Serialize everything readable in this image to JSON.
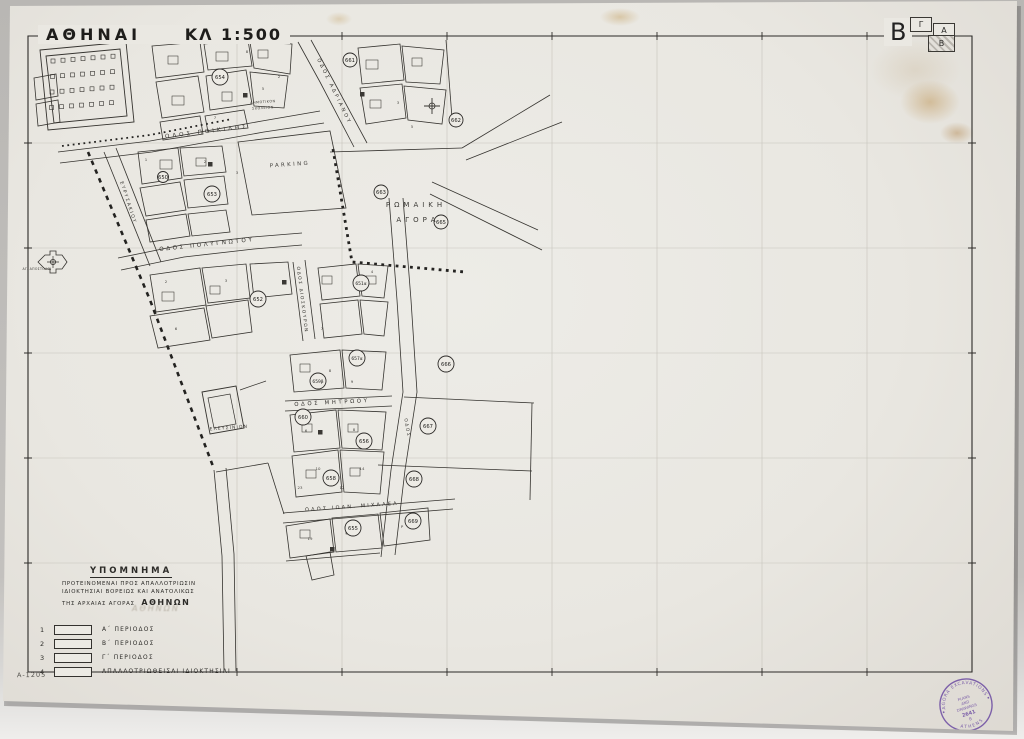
{
  "sheet": {
    "title": "ΑΘΗΝΑΙ",
    "scale": "ΚΛ 1:500",
    "sheet_letter": "B",
    "ref_number": "A-1205",
    "index_boxes": [
      {
        "label": "Γ"
      },
      {
        "label": "Α"
      },
      {
        "label": "Β"
      }
    ]
  },
  "legend": {
    "title": "ΥΠΟΜΝΗΜΑ",
    "subtitle_lines": [
      "ΠΡΟΤΕΙΝΟΜΕΝΑΙ ΠΡΟΣ ΑΠΑΛΛΟΤΡΙΩΣΙΝ",
      "ΙΔΙΟΚΤΗΣΙΑΙ ΒΟΡΕΙΩΣ ΚΑΙ ΑΝΑΤΟΛΙΚΩΣ",
      "ΤΗΣ ΑΡΧΑΙΑΣ ΑΓΟΡΑΣ"
    ],
    "highlight": "ΑΘΗΝΩΝ",
    "pencil_note": "ΑΘΗΝΩΝ",
    "items": [
      {
        "num": "1",
        "label": "Α΄ ΠΕΡΙΟΔΟΣ"
      },
      {
        "num": "2",
        "label": "Β΄ ΠΕΡΙΟΔΟΣ"
      },
      {
        "num": "3",
        "label": "Γ΄ ΠΕΡΙΟΔΟΣ"
      },
      {
        "num": "4",
        "label": "ΑΠΑΛΛΟΤΡΙΩΘΕΙΣΑΙ ΙΔΙΟΚΤΗΣΙΑΙ"
      }
    ]
  },
  "stamp": {
    "rim_top": "AGORA EXCAVATIONS",
    "rim_bottom": "ATHENS",
    "center_lines": [
      "PLANS",
      "AND",
      "DRAWINGS"
    ],
    "number": "2641",
    "letter": "Β",
    "color": "#6f4fa3"
  },
  "map": {
    "ink_color": "#35332f",
    "area_labels": [
      {
        "text": "ΡΩΜΑΙΚΗ",
        "x": 416,
        "y": 207,
        "fs": 7,
        "ls": 4,
        "rot": 0
      },
      {
        "text": "ΑΓΟΡΑ",
        "x": 418,
        "y": 222,
        "fs": 7,
        "ls": 4,
        "rot": 0
      },
      {
        "text": "PARKING",
        "x": 290,
        "y": 166,
        "fs": 5.4,
        "ls": 2.4,
        "rot": -4
      },
      {
        "text": "ΕΛΕΥΣΙΝΙΟΝ",
        "x": 229,
        "y": 429,
        "fs": 4.4,
        "ls": 1.2,
        "rot": -4
      },
      {
        "text": "ΑΓ. ΑΠΟΣΤΟΛΟΙ",
        "x": 37,
        "y": 270,
        "fs": 3.2,
        "ls": 0.3,
        "rot": 0
      },
      {
        "text": "ΔΗΜΟΤΙΚΟΝ",
        "x": 263,
        "y": 103,
        "fs": 3.4,
        "ls": 0.5,
        "rot": -4
      },
      {
        "text": "ΣΧΟΛΕΙΟΝ",
        "x": 263,
        "y": 109,
        "fs": 3.4,
        "ls": 0.5,
        "rot": -4
      }
    ],
    "street_labels": [
      {
        "text": "ΟΔΟΣ ΠΟΙΚΙΛΗΣ",
        "x": 207,
        "y": 133,
        "rot": -7,
        "fs": 5.6,
        "ls": 3
      },
      {
        "text": "ΟΔΟΣ ΠΟΛΥΓΝΩΤΟΥ",
        "x": 207,
        "y": 246,
        "rot": -6,
        "fs": 5.6,
        "ls": 2.6
      },
      {
        "text": "ΟΔΟΣ ΑΔΡΙΑΝΟΥ",
        "x": 333,
        "y": 92,
        "rot": 64,
        "fs": 5,
        "ls": 2.4
      },
      {
        "text": "ΕΥΡΥΣΑΚΙΟΥ",
        "x": 127,
        "y": 203,
        "rot": 72,
        "fs": 4.6,
        "ls": 1.6
      },
      {
        "text": "ΟΔΟΣ ΔΙΟΣΚΟΥΡΩΝ",
        "x": 301,
        "y": 300,
        "rot": 83,
        "fs": 4.4,
        "ls": 1.6
      },
      {
        "text": "ΟΔΟΣ ΜΗΤΡΩΟΥ",
        "x": 332,
        "y": 404,
        "rot": -3,
        "fs": 5.4,
        "ls": 2.6
      },
      {
        "text": "ΟΔΟΣ ΙΩΑΝ. ΜΙΧΑΛΕΑ",
        "x": 352,
        "y": 508,
        "rot": -4,
        "fs": 5,
        "ls": 2.2
      },
      {
        "text": "ΟΔΟΣ",
        "x": 406,
        "y": 428,
        "rot": 80,
        "fs": 4.4,
        "ls": 1.6
      }
    ],
    "circled_numbers": [
      {
        "n": "650",
        "x": 163,
        "y": 177,
        "r": 5.5
      },
      {
        "n": "654",
        "x": 220,
        "y": 77,
        "r": 8
      },
      {
        "n": "661",
        "x": 350,
        "y": 60,
        "r": 7
      },
      {
        "n": "662",
        "x": 456,
        "y": 120,
        "r": 7
      },
      {
        "n": "653",
        "x": 212,
        "y": 194,
        "r": 8
      },
      {
        "n": "663",
        "x": 381,
        "y": 192,
        "r": 7
      },
      {
        "n": "665",
        "x": 441,
        "y": 222,
        "r": 7
      },
      {
        "n": "652",
        "x": 258,
        "y": 299,
        "r": 8
      },
      {
        "n": "651α",
        "x": 361,
        "y": 283,
        "r": 8
      },
      {
        "n": "657α",
        "x": 357,
        "y": 358,
        "r": 8
      },
      {
        "n": "666",
        "x": 446,
        "y": 364,
        "r": 8
      },
      {
        "n": "659β",
        "x": 318,
        "y": 381,
        "r": 8
      },
      {
        "n": "660",
        "x": 303,
        "y": 417,
        "r": 8
      },
      {
        "n": "656",
        "x": 364,
        "y": 441,
        "r": 8
      },
      {
        "n": "667",
        "x": 428,
        "y": 426,
        "r": 8
      },
      {
        "n": "658",
        "x": 331,
        "y": 478,
        "r": 8
      },
      {
        "n": "668",
        "x": 414,
        "y": 479,
        "r": 8
      },
      {
        "n": "655",
        "x": 353,
        "y": 528,
        "r": 8
      },
      {
        "n": "669",
        "x": 413,
        "y": 521,
        "r": 8
      }
    ],
    "plot_numbers": [
      {
        "t": "1",
        "x": 146,
        "y": 161
      },
      {
        "t": "2",
        "x": 205,
        "y": 163
      },
      {
        "t": "3",
        "x": 237,
        "y": 174
      },
      {
        "t": "5",
        "x": 263,
        "y": 90
      },
      {
        "t": "7",
        "x": 215,
        "y": 119
      },
      {
        "t": "8",
        "x": 247,
        "y": 53
      },
      {
        "t": "2",
        "x": 279,
        "y": 78
      },
      {
        "t": "3",
        "x": 398,
        "y": 104
      },
      {
        "t": "5",
        "x": 412,
        "y": 128
      },
      {
        "t": "2",
        "x": 166,
        "y": 283
      },
      {
        "t": "3",
        "x": 226,
        "y": 282
      },
      {
        "t": "6",
        "x": 176,
        "y": 330
      },
      {
        "t": "7",
        "x": 322,
        "y": 330
      },
      {
        "t": "4",
        "x": 372,
        "y": 273
      },
      {
        "t": "8",
        "x": 330,
        "y": 372
      },
      {
        "t": "9",
        "x": 352,
        "y": 383
      },
      {
        "t": "6",
        "x": 306,
        "y": 432
      },
      {
        "t": "8",
        "x": 354,
        "y": 431
      },
      {
        "t": "10",
        "x": 318,
        "y": 470
      },
      {
        "t": "12",
        "x": 342,
        "y": 489
      },
      {
        "t": "23",
        "x": 300,
        "y": 489
      },
      {
        "t": "14",
        "x": 362,
        "y": 470
      },
      {
        "t": "19",
        "x": 310,
        "y": 540
      },
      {
        "t": "Ρ",
        "x": 402,
        "y": 528
      }
    ]
  }
}
